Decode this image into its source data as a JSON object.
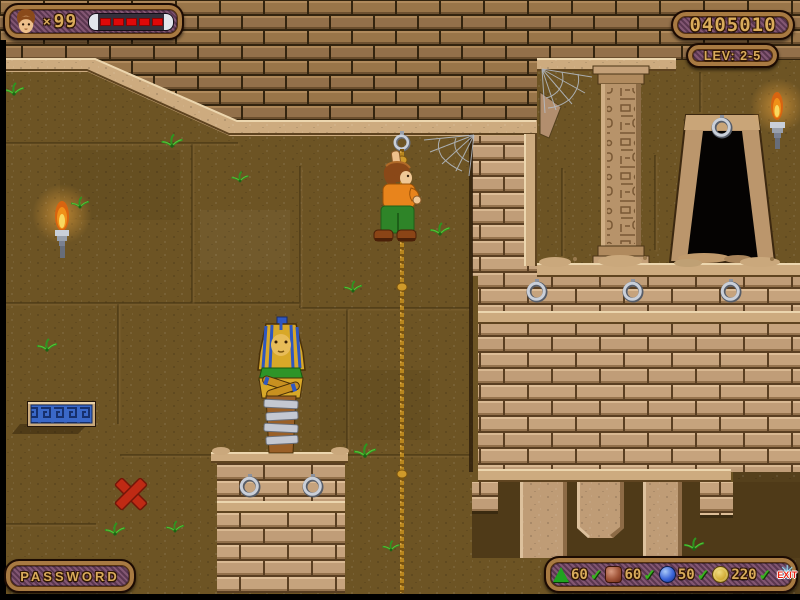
{
  "hud": {
    "lives": {
      "icon": "player-head-icon",
      "times": "×",
      "count": "99",
      "health_segments": 5,
      "health_color": "#e00808"
    },
    "score": {
      "value": "0405010"
    },
    "level": {
      "label": "LEV: 2-5"
    },
    "password": {
      "label": "PASSWORD"
    },
    "inventory": {
      "checkmark": "✓",
      "exit_star": "✳",
      "exit_label": "EXIT",
      "items": [
        {
          "icon": "green-gem-icon",
          "count": "60",
          "collected": true
        },
        {
          "icon": "red-gem-icon",
          "count": "60",
          "collected": true
        },
        {
          "icon": "blue-gem-icon",
          "count": "50",
          "collected": true
        },
        {
          "icon": "gold-coin-icon",
          "count": "220",
          "collected": true
        }
      ]
    }
  },
  "colors": {
    "hud_gold": "#d9ab5b",
    "hud_purple": "#6f4662",
    "hud_frame": "#a87a42",
    "health_red": "#e00808",
    "check_green": "#39b41e",
    "exit_red": "#e82212",
    "wall_brown": "#6d5424",
    "brick_tan": "#c6a37d",
    "rope_gold": "#b8861e",
    "platform_blue": "#3a68c8"
  },
  "scene": {
    "objects": [
      "player-character",
      "climbing-rope",
      "rope-anchor-ring",
      "sarcophagus-statue",
      "stone-pedestal",
      "pedestal-rings",
      "wall-rings",
      "hieroglyph-column",
      "dark-doorway",
      "doorway-ring",
      "wall-torch-left",
      "wall-torch-right",
      "spider-web-left",
      "spider-web-right",
      "greek-key-platform",
      "red-x-mark",
      "vine-plants",
      "brick-ceiling",
      "brick-block",
      "hanging-pillars",
      "rubble-piles"
    ]
  }
}
